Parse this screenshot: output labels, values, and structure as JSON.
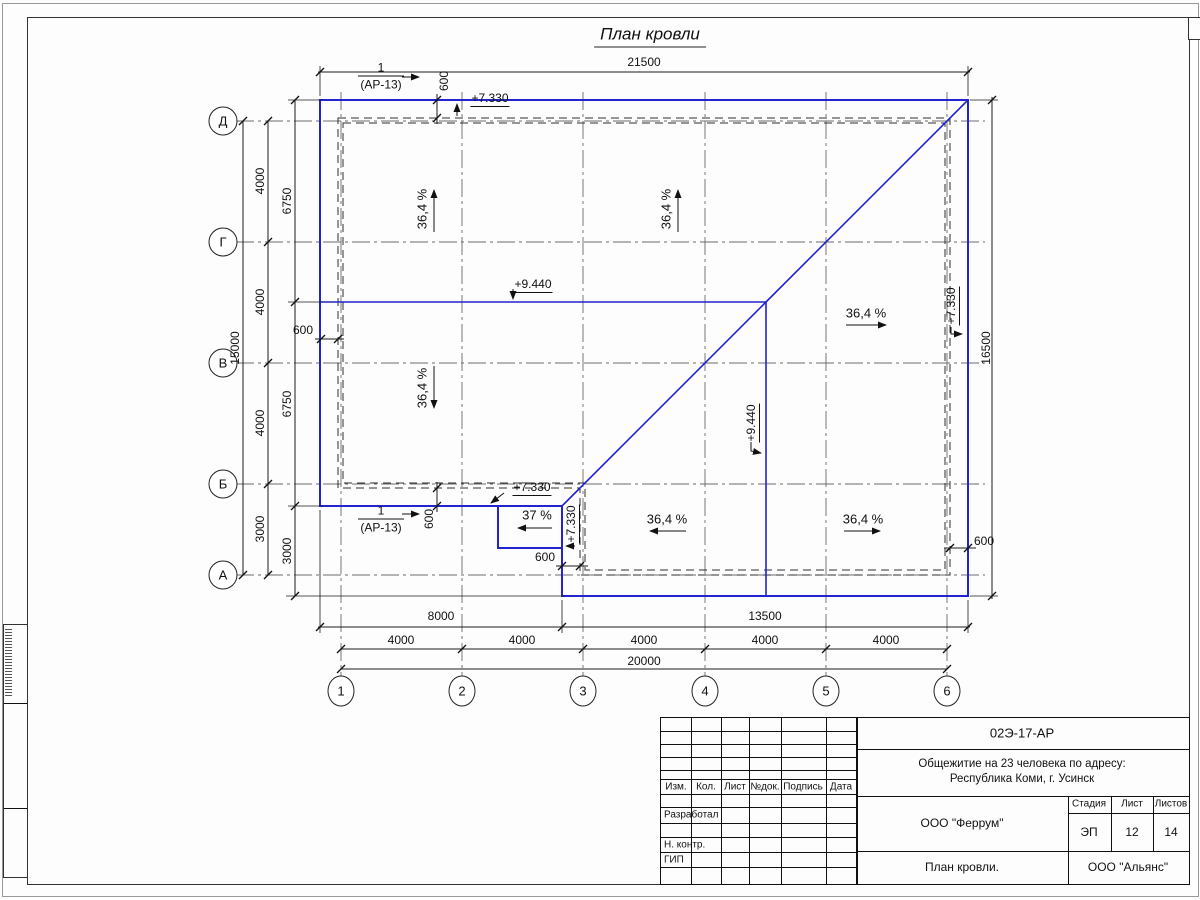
{
  "sheet": {
    "title": "План кровли"
  },
  "axes": {
    "rows": [
      "Д",
      "Г",
      "В",
      "Б",
      "А"
    ],
    "cols": [
      "1",
      "2",
      "3",
      "4",
      "5",
      "6"
    ]
  },
  "dims": {
    "top": "21500",
    "right": "16500",
    "left_total": "15000",
    "left_spans": [
      "4000",
      "4000",
      "4000",
      "3000"
    ],
    "left_wall": [
      "6750",
      "6750",
      "3000"
    ],
    "bottom_walls": [
      "8000",
      "13500"
    ],
    "bottom_spans": [
      "4000",
      "4000",
      "4000",
      "4000",
      "4000"
    ],
    "bottom_total": "20000",
    "offset": "600"
  },
  "marks": {
    "section_num": "1",
    "section_ref": "(АР-13)",
    "elev_roof": "+7.330",
    "elev_ridge": "+9.440"
  },
  "slopes": {
    "main": "36,4 %",
    "porch": "37 %"
  },
  "titleblock": {
    "doc_code": "02Э-17-АР",
    "project_line1": "Общежитие на 23 человека по адресу:",
    "project_line2": "Республика Коми, г. Усинск",
    "org": "ООО \"Феррум\"",
    "sheet_name": "План кровли.",
    "contractor": "ООО \"Альянс\"",
    "stage_label": "Стадия",
    "sheet_label": "Лист",
    "sheets_label": "Листов",
    "stage": "ЭП",
    "sheet_no": "12",
    "sheets_total": "14",
    "rev_cols": [
      "Изм.",
      "Кол.",
      "Лист",
      "№док.",
      "Подпись",
      "Дата"
    ],
    "roles": [
      "Разработал",
      "Н. контр.",
      "ГИП"
    ]
  },
  "colors": {
    "roof_line": "#2323cf"
  }
}
